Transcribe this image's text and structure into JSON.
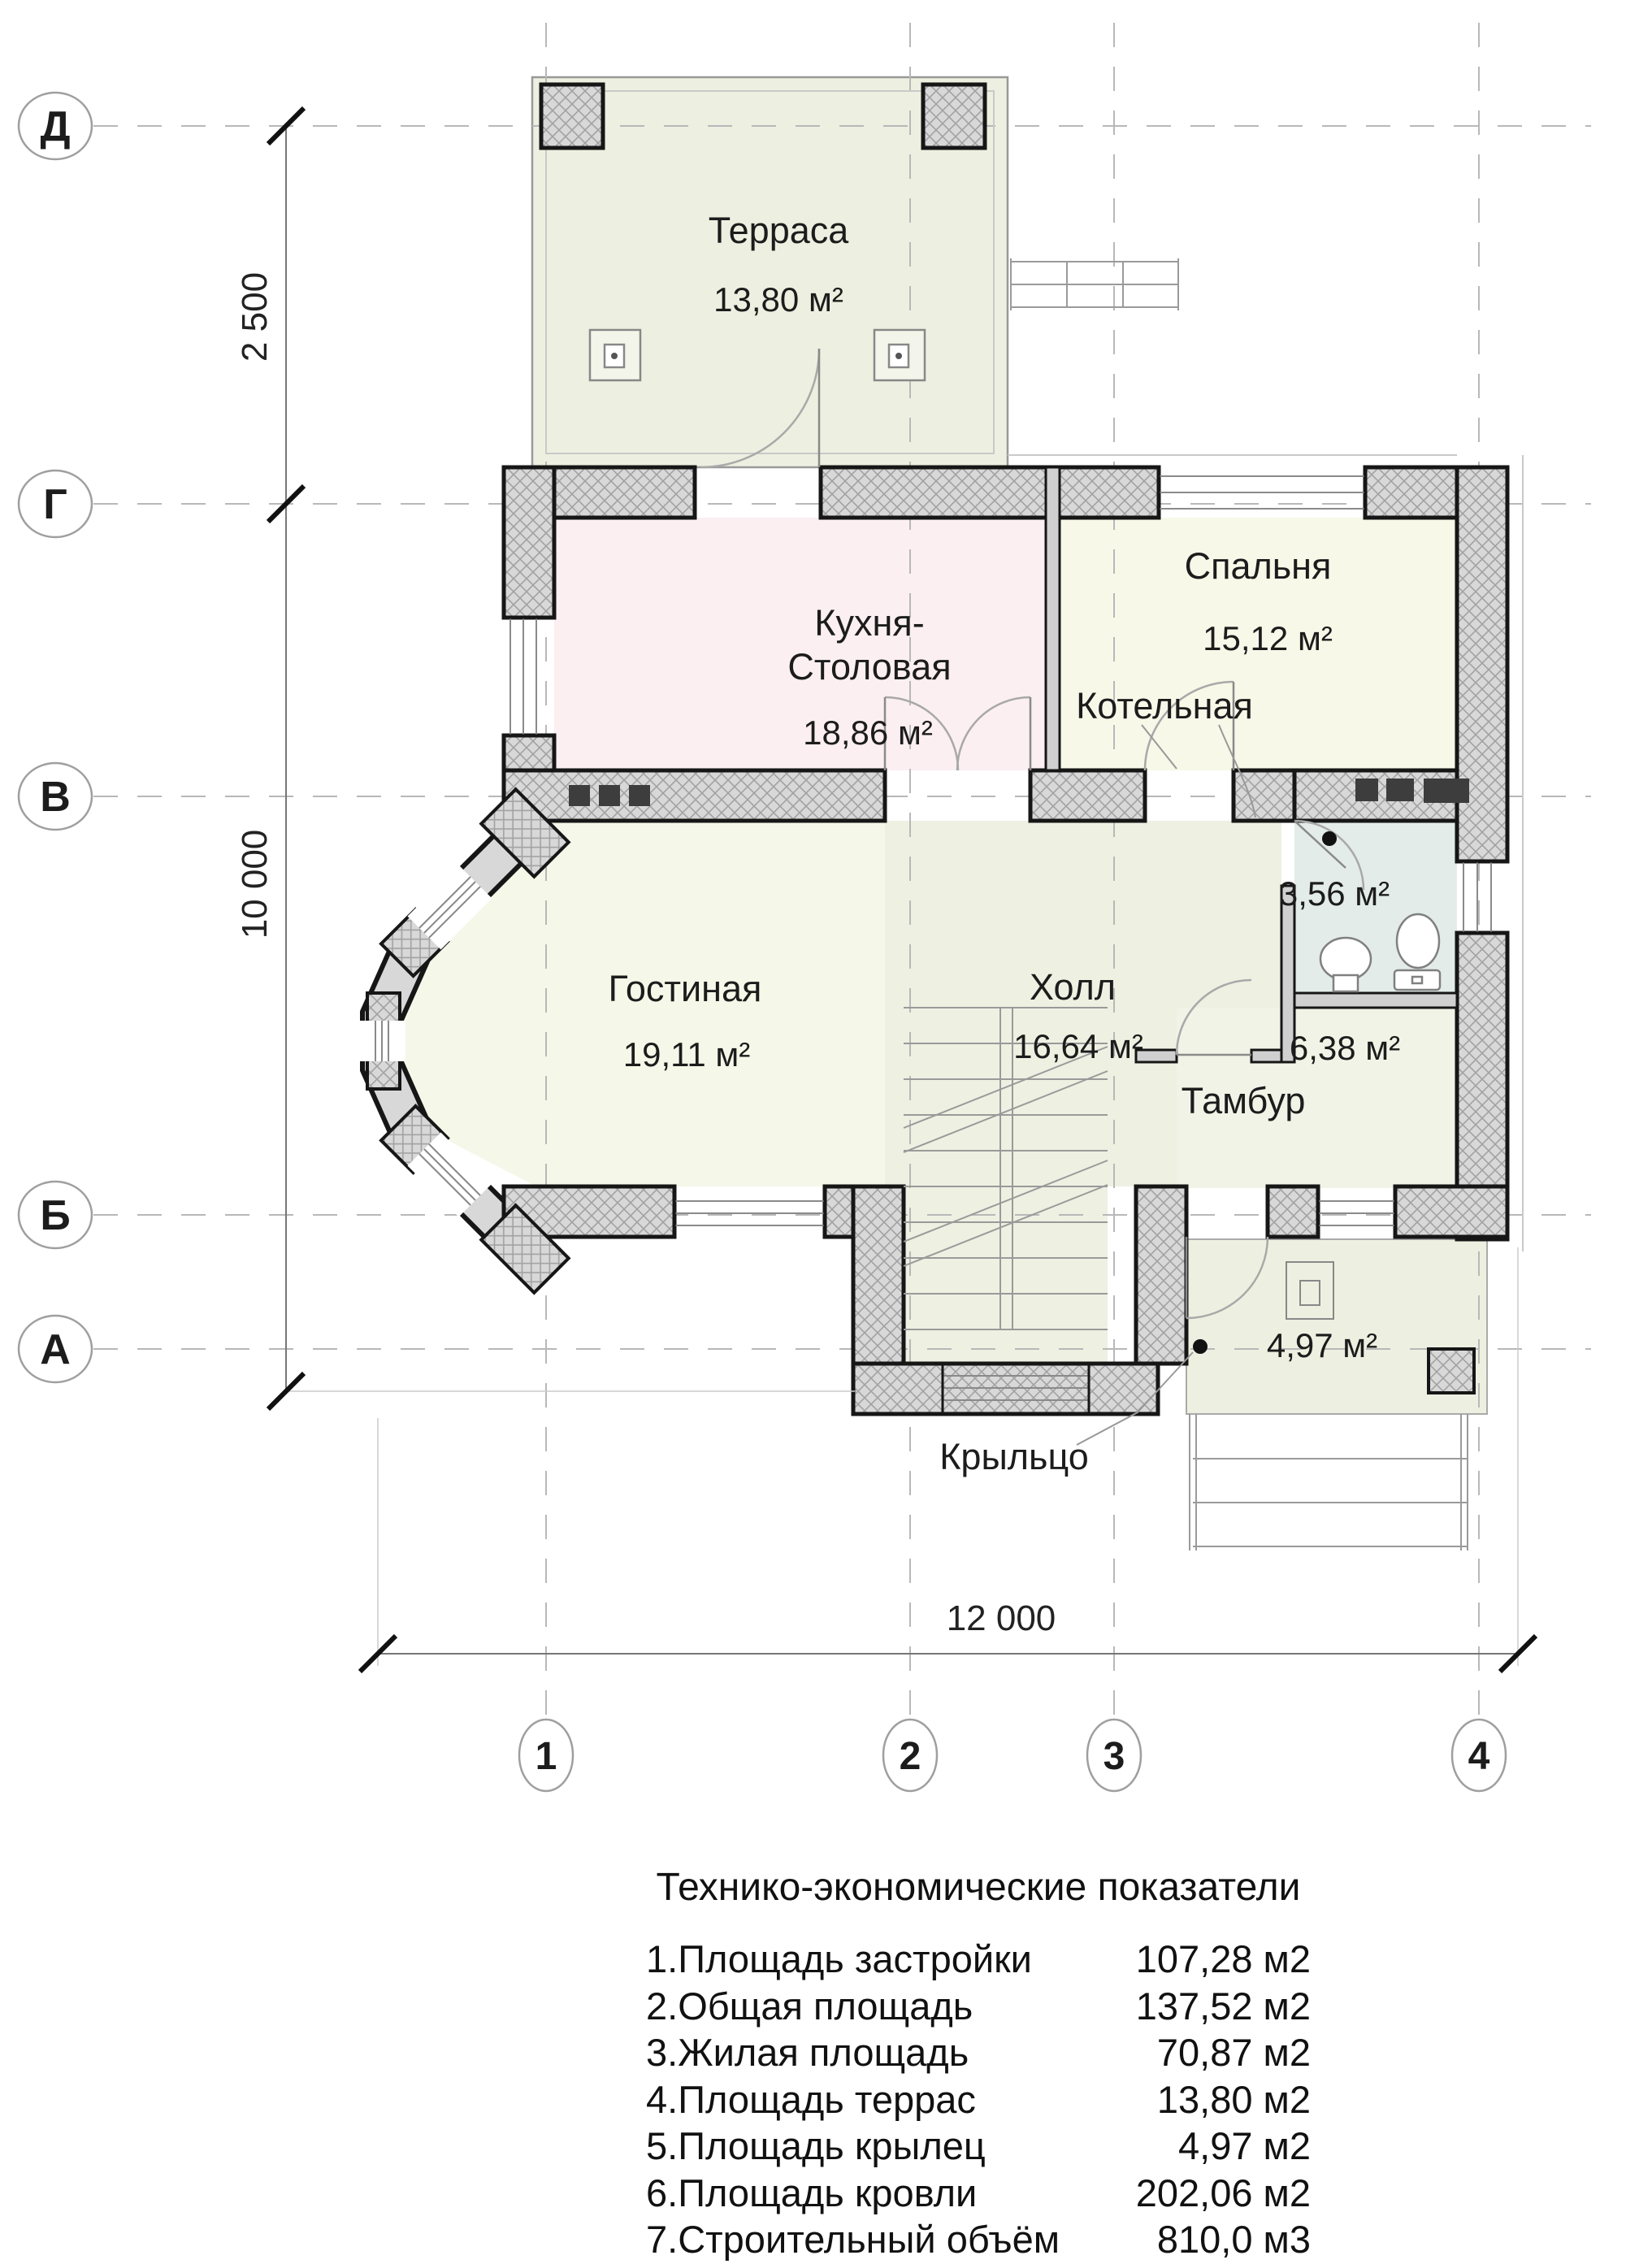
{
  "rooms": {
    "terrace": {
      "name": "Терраса",
      "area": "13,80 м²"
    },
    "kitchen": {
      "name_line1": "Кухня-",
      "name_line2": "Столовая",
      "area": "18,86 м²"
    },
    "bedroom": {
      "name": "Спальня",
      "area": "15,12 м²"
    },
    "boiler": {
      "name": "Котельная"
    },
    "living": {
      "name": "Гостиная",
      "area": "19,11 м²"
    },
    "hall": {
      "name": "Холл",
      "area": "16,64 м²"
    },
    "bathroom": {
      "area": "3,56 м²"
    },
    "tambur": {
      "name": "Тамбур",
      "area": "6,38 м²"
    },
    "porch": {
      "name": "Крыльцо",
      "area": "4,97 м²"
    }
  },
  "grid": {
    "rows": [
      "Д",
      "Г",
      "В",
      "Б",
      "А"
    ],
    "cols": [
      "1",
      "2",
      "3",
      "4"
    ]
  },
  "dimensions": {
    "vertical_top": "2 500",
    "vertical_main": "10 000",
    "horizontal": "12 000"
  },
  "table": {
    "title": "Технико-экономические показатели",
    "rows": [
      {
        "label": "1.Площадь застройки",
        "value": "107,28 м2"
      },
      {
        "label": "2.Общая площадь",
        "value": "137,52 м2"
      },
      {
        "label": "3.Жилая площадь",
        "value": "70,87 м2"
      },
      {
        "label": "4.Площадь террас",
        "value": "13,80 м2"
      },
      {
        "label": "5.Площадь крылец",
        "value": "4,97 м2"
      },
      {
        "label": "6.Площадь кровли",
        "value": "202,06 м2"
      },
      {
        "label": "7.Строительный объём",
        "value": "810,0 м3"
      }
    ]
  },
  "colors": {
    "terrace": "#edefe0",
    "kitchen": "#fbeff2",
    "bedroom": "#f7f8e8",
    "living": "#f5f7e8",
    "hall": "#eef0e2",
    "bathroom": "#e3ece8",
    "tambur": "#f1f3e6",
    "porch": "#edf0e0",
    "vent": "#3d3d3d"
  }
}
